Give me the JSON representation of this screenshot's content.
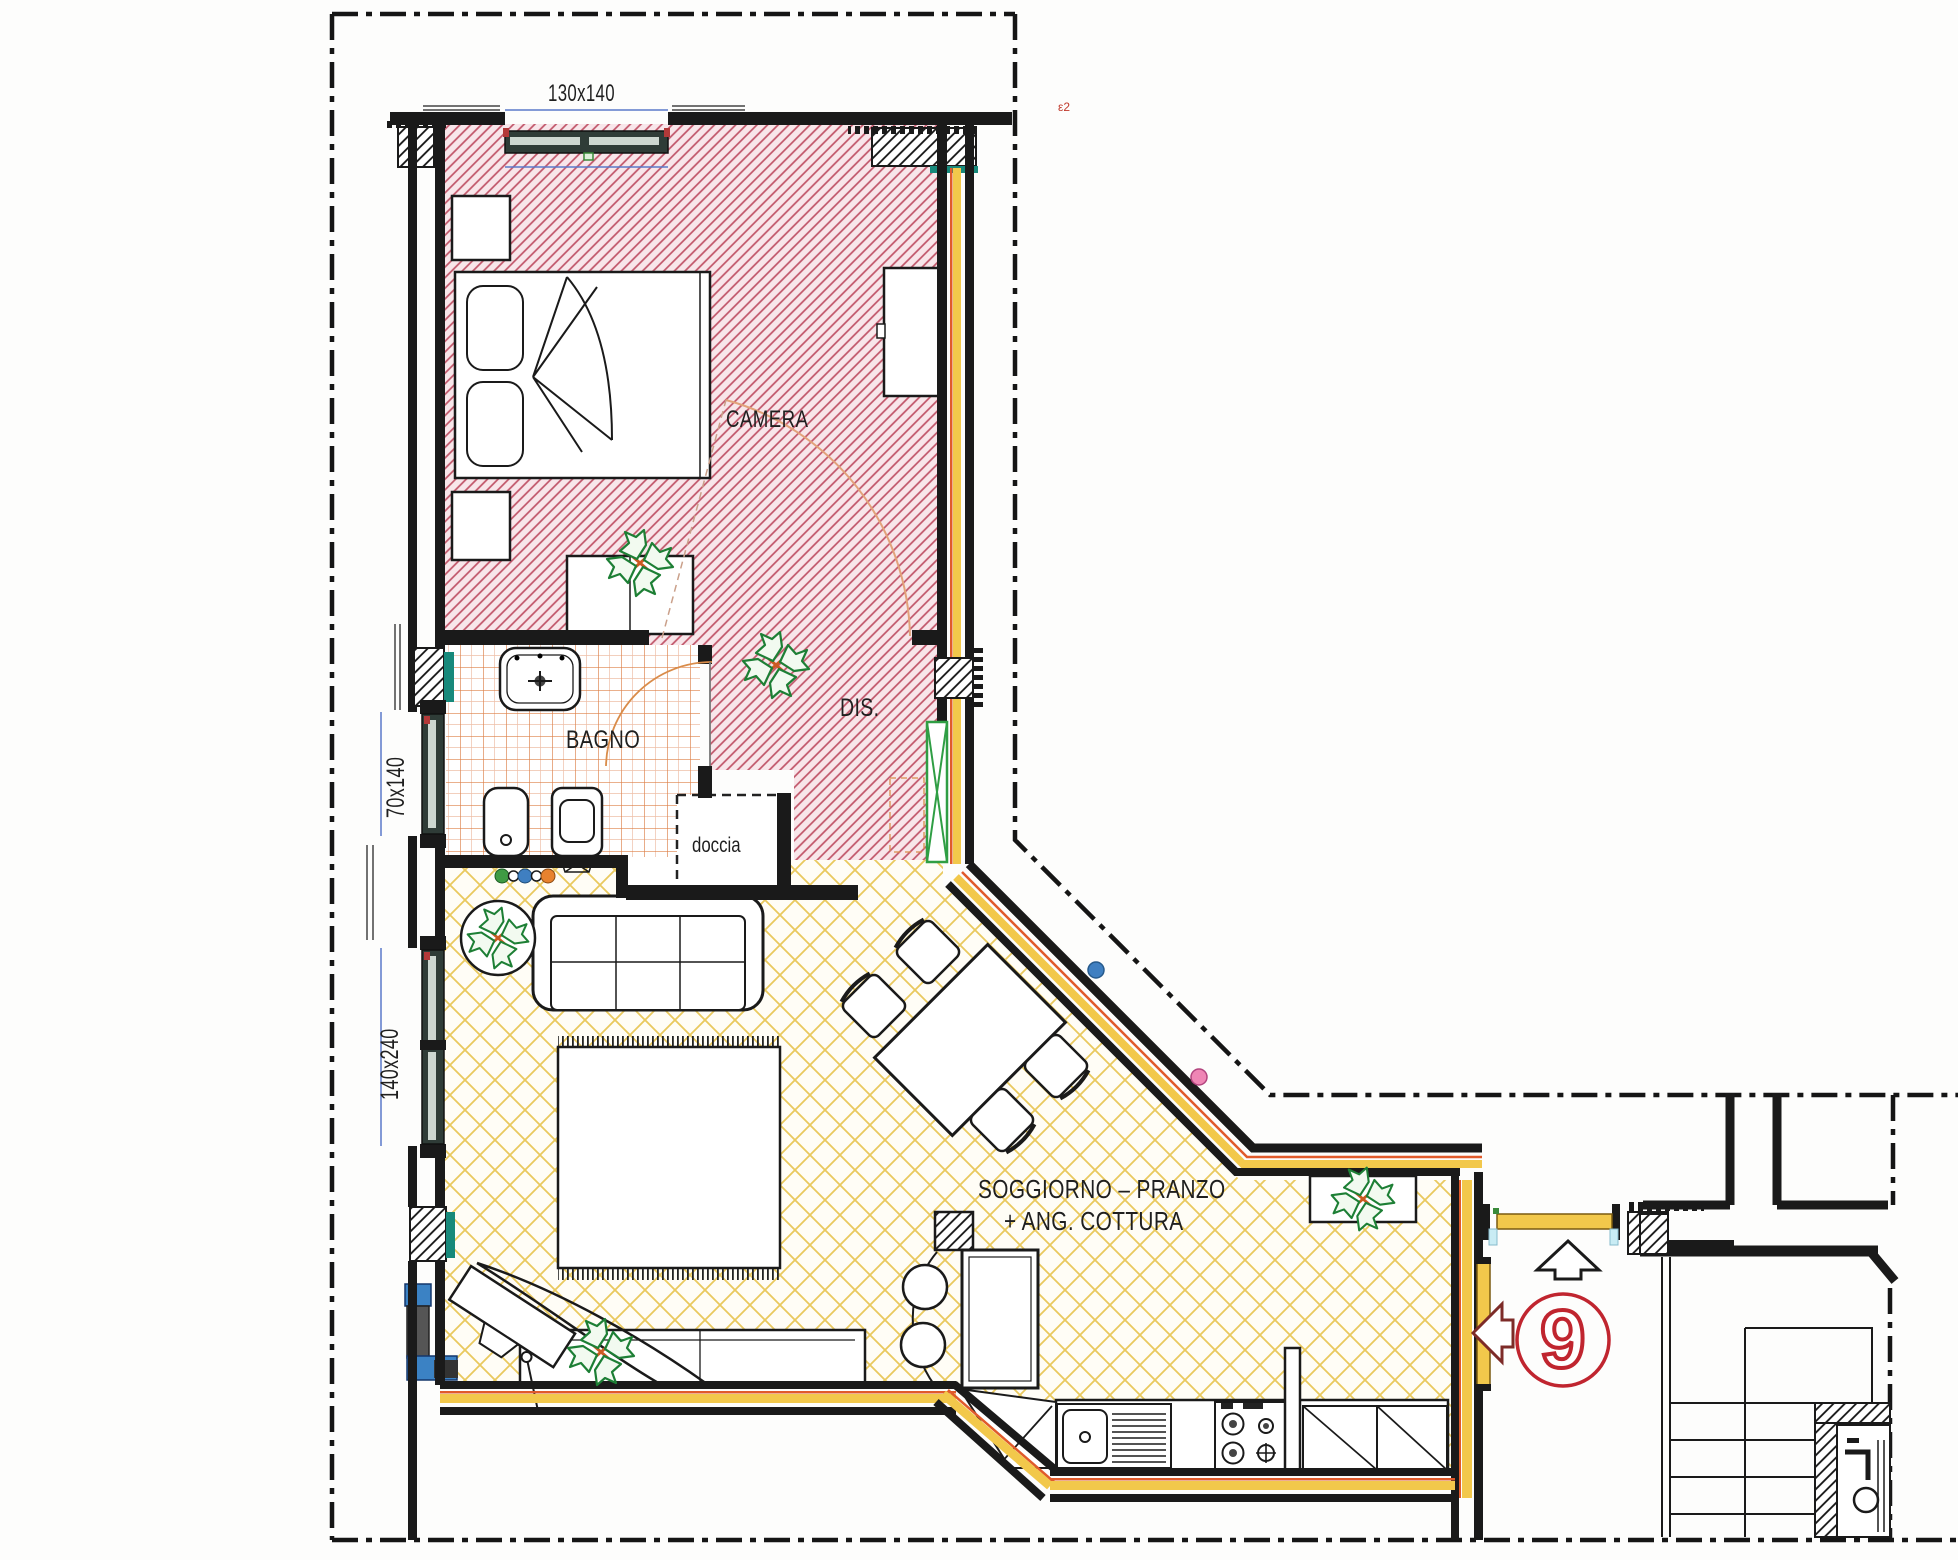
{
  "labels": {
    "dim_window_top": "130x140",
    "room_camera": "CAMERA",
    "room_bagno": "BAGNO",
    "shower": "doccia",
    "room_dis": "DIS.",
    "dim_window_bagno": "70x140",
    "dim_window_living": "140x240",
    "room_living_line1": "SOGGIORNO – PRANZO",
    "room_living_line2": "+ ANG. COTTURA",
    "unit_number": "9",
    "corner_mark": "ε2"
  },
  "colors": {
    "camera_hatch": "#c05468",
    "bagno_tile": "#dd8048",
    "living_lattice": "#e9c95e",
    "insulation_yellow": "#f2c84b",
    "insulation_orange": "#e05a2b",
    "accent_teal": "#17897b",
    "door_yellow": "#f2c84b",
    "unit_marker_red": "#c0252f",
    "dot_blue": "#3f7fc1",
    "dot_pink": "#ef86b5",
    "plant_green": "#1d7f35",
    "dim_blue": "#5b79c9"
  }
}
